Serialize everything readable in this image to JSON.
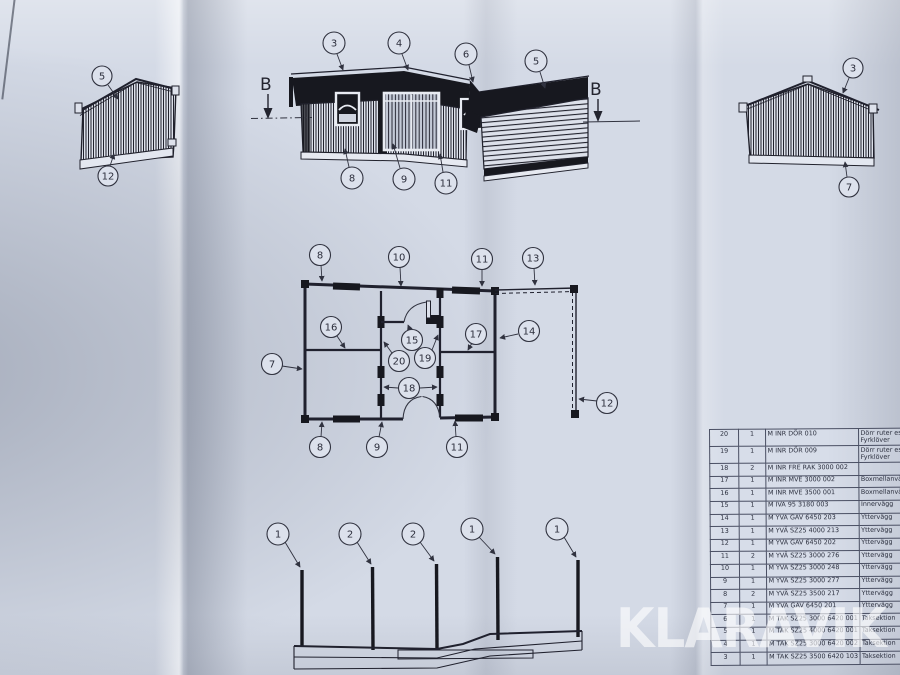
{
  "callouts": {
    "section_marker": "B",
    "left_gable": [
      "5",
      "12"
    ],
    "right_gable": [
      "3",
      "7"
    ],
    "front_elevation": [
      "3",
      "4",
      "6",
      "5",
      "8",
      "9",
      "11"
    ],
    "floor_plan": {
      "top": [
        "8",
        "10",
        "11",
        "13"
      ],
      "left": [
        "7"
      ],
      "inner": [
        "16",
        "15",
        "20",
        "19",
        "17",
        "14",
        "18"
      ],
      "right": [
        "12"
      ],
      "bottom": [
        "8",
        "9",
        "11"
      ]
    },
    "base_section": [
      "1",
      "2",
      "2",
      "1",
      "1"
    ]
  },
  "parts_table": {
    "rows": [
      [
        "20",
        "1",
        "M INR DÖR 010",
        "Dörr ruter ess Fyrklöver"
      ],
      [
        "19",
        "1",
        "M INR DÖR 009",
        "Dörr ruter ess Fyrklöver"
      ],
      [
        "18",
        "2",
        "M INR FRE RAK 3000 002",
        ""
      ],
      [
        "17",
        "1",
        "M INR MVE 3000 002",
        "Boxmellanvägg"
      ],
      [
        "16",
        "1",
        "M INR MVE 3500 001",
        "Boxmellanvägg"
      ],
      [
        "15",
        "1",
        "M IVÄ 95 3180 003",
        "Innervägg"
      ],
      [
        "14",
        "1",
        "M YVÄ GAV 6450 203",
        "Yttervägg"
      ],
      [
        "13",
        "1",
        "M YVÄ SZ25 4000 213",
        "Yttervägg"
      ],
      [
        "12",
        "1",
        "M YVÄ GAV 6450 202",
        "Yttervägg"
      ],
      [
        "11",
        "2",
        "M YVÄ SZ25 3000 276",
        "Yttervägg"
      ],
      [
        "10",
        "1",
        "M YVÄ SZ25 3000 248",
        "Yttervägg"
      ],
      [
        "9",
        "1",
        "M YVÄ SZ25 3000 277",
        "Yttervägg"
      ],
      [
        "8",
        "2",
        "M YVÄ SZ25 3500 217",
        "Yttervägg"
      ],
      [
        "7",
        "1",
        "M YVÄ GAV 6450 201",
        "Yttervägg"
      ],
      [
        "6",
        "1",
        "M TAK SZ25 3000 6420 001",
        "Taksektion"
      ],
      [
        "5",
        "1",
        "M TAK SZ25 4000 6420 001",
        "Taksektion"
      ],
      [
        "4",
        "1",
        "M TAK SZ25 3000 6420 002",
        "Taksektion"
      ],
      [
        "3",
        "1",
        "M TAK SZ25 3500 6420 103",
        "Taksektion"
      ]
    ]
  },
  "watermark": {
    "text": "KLARAVIK"
  },
  "colors": {
    "paper": "#d4dae6",
    "ink": "#20212e",
    "dark_fill": "#17181f",
    "watermark": "rgba(255,255,255,0.62)"
  }
}
